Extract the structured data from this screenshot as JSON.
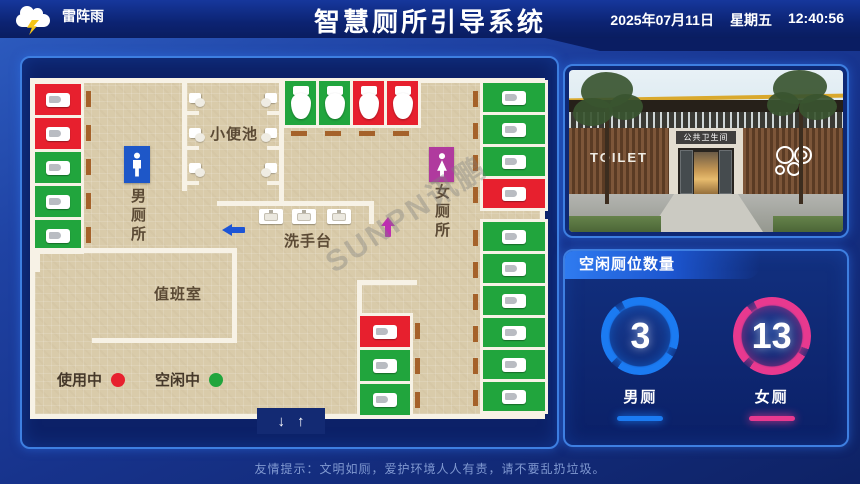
{
  "header": {
    "weather": "雷阵雨",
    "title": "智慧厕所引导系统",
    "date": "2025年07月11日",
    "weekday": "星期五",
    "time": "12:40:56"
  },
  "floor_plan": {
    "watermark": "SUNPN讯鹏",
    "men_room": "男厕所",
    "women_room": "女厕所",
    "urinal": "小便池",
    "sink": "洗手台",
    "duty_room": "值班室",
    "legend": {
      "in_use": "使用中",
      "free": "空闲中"
    },
    "entrance": {
      "down": "↓",
      "up": "↑"
    },
    "status_colors": {
      "occupied": "#e7202e",
      "free": "#21a53d"
    },
    "stall_groups": {
      "left_column": [
        "occupied",
        "occupied",
        "free",
        "free",
        "free"
      ],
      "top_row": [
        "free",
        "free",
        "occupied",
        "occupied"
      ],
      "right_column_upper": [
        "free",
        "free",
        "free",
        "occupied"
      ],
      "right_column_lower": [
        "free",
        "free",
        "free",
        "free",
        "free",
        "free"
      ],
      "middle_column": [
        "occupied",
        "free",
        "free"
      ]
    }
  },
  "photo": {
    "wall_text": "TOILET",
    "sign": "公共卫生间"
  },
  "stats": {
    "title": "空闲厕位数量",
    "items": [
      {
        "label": "男厕",
        "value": "3",
        "color": "#1b7bf2"
      },
      {
        "label": "女厕",
        "value": "13",
        "color": "#e8398f"
      }
    ]
  },
  "footer": "友情提示：文明如厕，爱护环境人人有责，请不要乱扔垃圾。"
}
